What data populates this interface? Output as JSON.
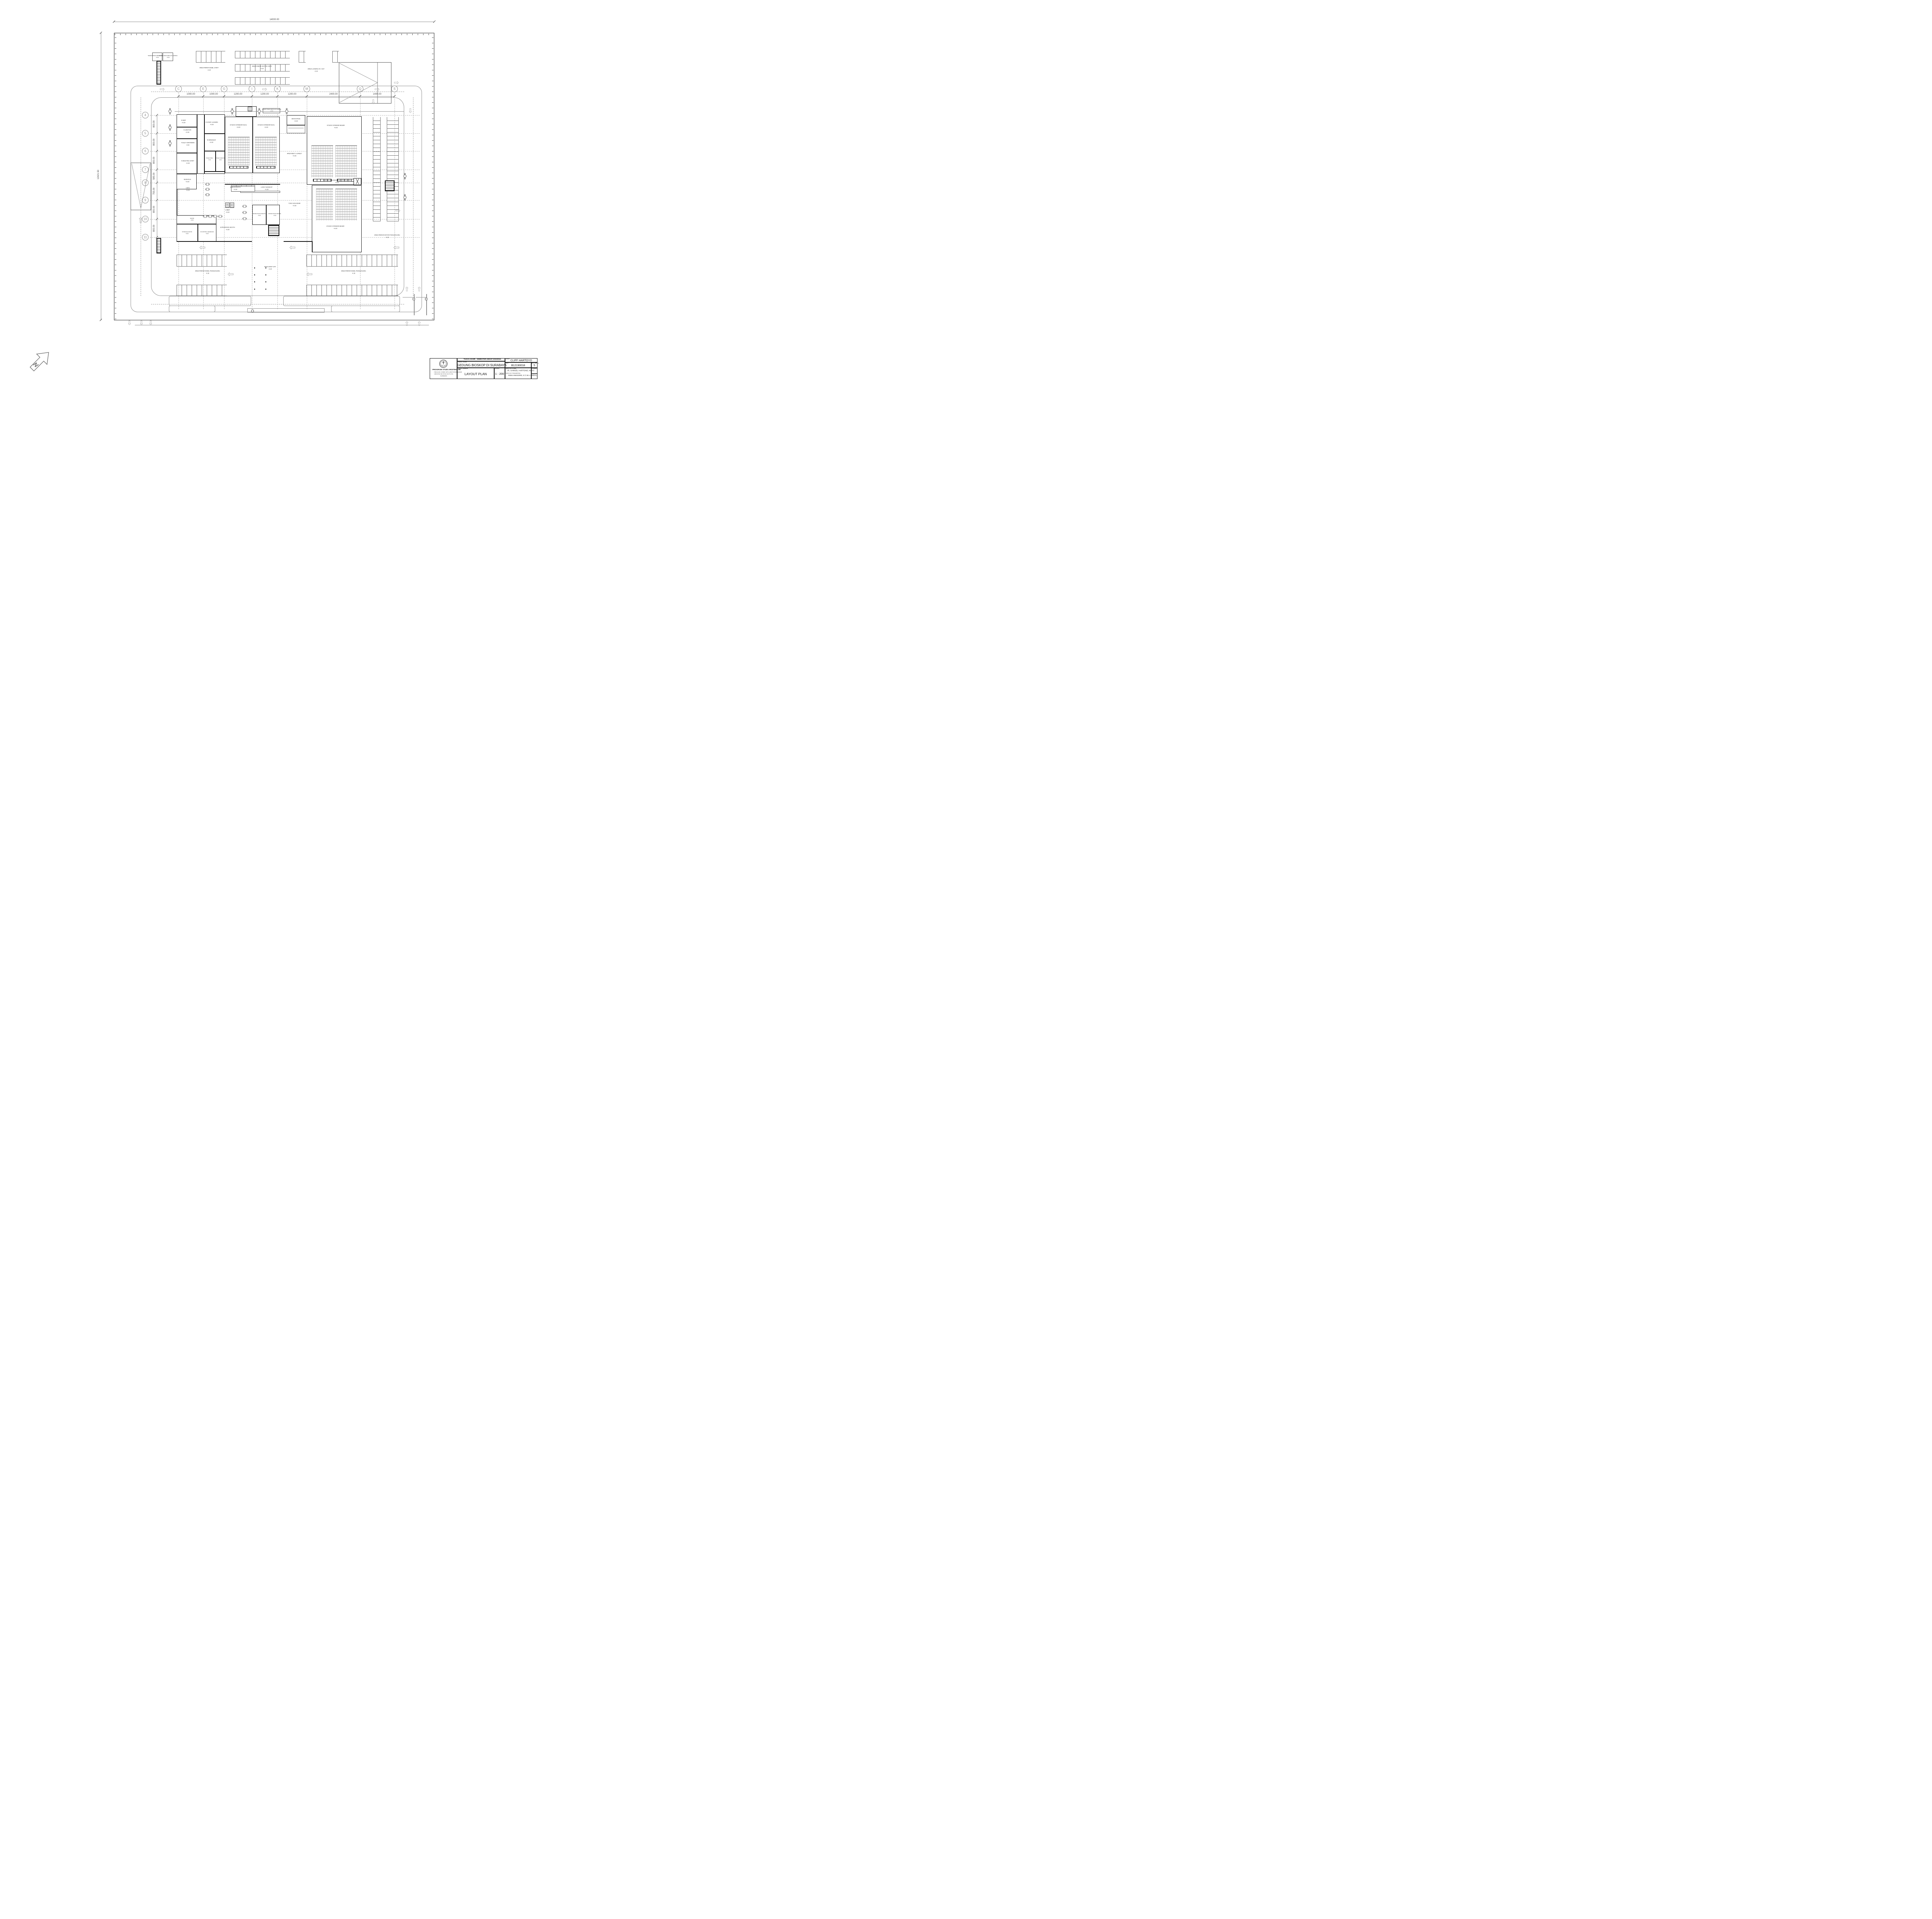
{
  "sheet": {
    "north_label": "N",
    "dim_top": "14000.00",
    "dim_left": "12421.50"
  },
  "grid": {
    "columns": [
      "C",
      "E",
      "G",
      "I",
      "K",
      "M",
      "Q",
      "S"
    ],
    "col_dims": [
      "1000.00",
      "1000.00",
      "1200.00",
      "1200.00",
      "1200.00",
      "2400.00",
      "1400.00"
    ],
    "rows": [
      "4",
      "5",
      "6",
      "7",
      "8",
      "9",
      "10",
      "11"
    ],
    "row_dims": [
      "800.00",
      "800.00",
      "800.00",
      "585.00",
      "755.00",
      "800.00",
      "800.00"
    ]
  },
  "rooms": {
    "mdp": {
      "label": "R.MDP",
      "level": "+0.00"
    },
    "janitor": {
      "label": "R.JANITOR",
      "level": "+0.00"
    },
    "toilet_karyawan": {
      "label": "TOILET KARYAWAN",
      "level": "-0.02"
    },
    "meeting_staff": {
      "label": "R.MEETING STAFF",
      "level": "+0.00"
    },
    "mushola": {
      "label": "MUSHOLA",
      "level": "+0.00"
    },
    "staff_admin": {
      "label": "R.STAFF & ADMIN",
      "level": "+0.00"
    },
    "manager": {
      "label": "R.MANAGER",
      "level": "+0.00"
    },
    "toilet_pria": {
      "label": "TOILET PRIA",
      "level": "-0.02"
    },
    "toilet_wanita": {
      "label": "TOILET WANITA",
      "level": "-0.02"
    },
    "studio_kecil_1": {
      "label": "STUDIO STANDAR KECIL",
      "level": "+0.00"
    },
    "studio_kecil_2": {
      "label": "STUDIO STANDAR KECIL",
      "level": "+0.00"
    },
    "backstage": {
      "label": "BACKSTAGE",
      "level": "+0.00"
    },
    "studio_besar_1": {
      "label": "STUDIO STANDAR BESAR",
      "level": "+0.00"
    },
    "studio_besar_2": {
      "label": "STUDIO STANDAR BESAR",
      "level": "+0.00"
    },
    "area_meet_greet": {
      "label": "AREA MEET & GREET",
      "level": "+0.00"
    },
    "gudang_proyektor": {
      "label": "GUDANG & RUANG AKSES PROYEKTOR",
      "level": "+0.00"
    },
    "cafe": {
      "label": "CAFE",
      "level": "+0.00"
    },
    "dapur": {
      "label": "DAPUR",
      "level": "+0.00"
    },
    "storage_dapur": {
      "label": "STORAGE DAPUR",
      "level": "+0.00"
    },
    "kontrol_keamanan": {
      "label": "R.KONTROL KEAMANAN",
      "level": "+0.00"
    },
    "snack_booth": {
      "label": "SNACK BOOTH",
      "level": "+0.00"
    },
    "loket_bioskop": {
      "label": "LOKET BIOSKOP",
      "level": "+0.00"
    },
    "lobby": {
      "label": "LOBBY",
      "level": "+0.00"
    },
    "toko_souvenir": {
      "label": "TOKO SOUVENIR",
      "level": "+0.00"
    },
    "movie_photo_booth_1": {
      "label": "MOVIE PHOTO BOOTH",
      "level": "+0.00"
    },
    "movie_photo_booth_2": {
      "label": "MOVIE PHOTO BOOTH",
      "level": "+0.00"
    },
    "experience_booth": {
      "label": "EXPERIENCE BOOTH",
      "level": "+0.00"
    },
    "sampah_site_1": {
      "label": "TEMPAT PENGUMPULAN SAMPAH",
      "level": "+0.00"
    },
    "sampah_site_2": {
      "label": "TEMPAT PENGUMPULAN SAMPAH",
      "level": "+0.00"
    },
    "sampah_gedung": {
      "label": "TEMPAT PENGUMPULAN SAMPAH",
      "level": "+0.00"
    }
  },
  "site": {
    "parkir_mobil_staff": {
      "label": "AREA PARKIR MOBIL STAFF",
      "level": "-0.15"
    },
    "parkir_motor_staff": {
      "label": "AREA PARKIR MOTOR STAFF",
      "level": "-0.15"
    },
    "loading": {
      "label": "AREA LOADING IN / OUT",
      "level": "-0.15"
    },
    "parkir_motor_pengunjung": {
      "label": "AREA PARKIR MOTOR PENGUNJUNG",
      "level": "-0.15"
    },
    "parkir_mobil_pengunjung_kiri": {
      "label": "AREA PARKIR MOBIL PENGUNJUNG",
      "level": "-0.15"
    },
    "parkir_mobil_pengunjung_kanan": {
      "label": "AREA PARKIR MOBIL PENGUNJUNG",
      "level": "-0.15"
    },
    "drop_off": {
      "label": "AREA DROP OFF",
      "level": "-0.15"
    }
  },
  "title_block": {
    "header": "TUGAS AKHIR - SEMESTER GENAP 2023/2024",
    "labels": {
      "judul_tugas": "JUDUL TUGAS",
      "judul_gambar": "JUDUL GAMBAR",
      "skala": "SKALA",
      "nama": "NAMA",
      "nrp": "NRP",
      "kelompok": "KELOMPOK",
      "mentor_utama": "MENTOR UTAMA",
      "mentor_pendamping": "MENTOR PENDAMPING",
      "lembar": "LEMBAR",
      "jumlah": "JUMLAH"
    },
    "judul_tugas": "GEDUNG BIOSKOP DI SURABAYA",
    "judul_gambar": "LAYOUT PLAN",
    "skala": "1 : 200",
    "nama": "CLIFF HARTOYO",
    "nrp": "B12190018",
    "kelompok": "5",
    "mentor_utama": "IR. SAMUEL HARTONO, M. SC",
    "mentor_pendamping": "RONI ANGGORO, S.T, M.A. (ARCH)",
    "lembar": "",
    "jumlah": "",
    "institution": {
      "prodi": "PROGRAM STUDI ARSITEKTUR",
      "fakultas": "FAKULTAS TEKNIK SIPIL DAN PERENCANAAN",
      "universitas": "UNIVERSITAS KRISTEN PETRA",
      "kota": "SURABAYA"
    }
  }
}
